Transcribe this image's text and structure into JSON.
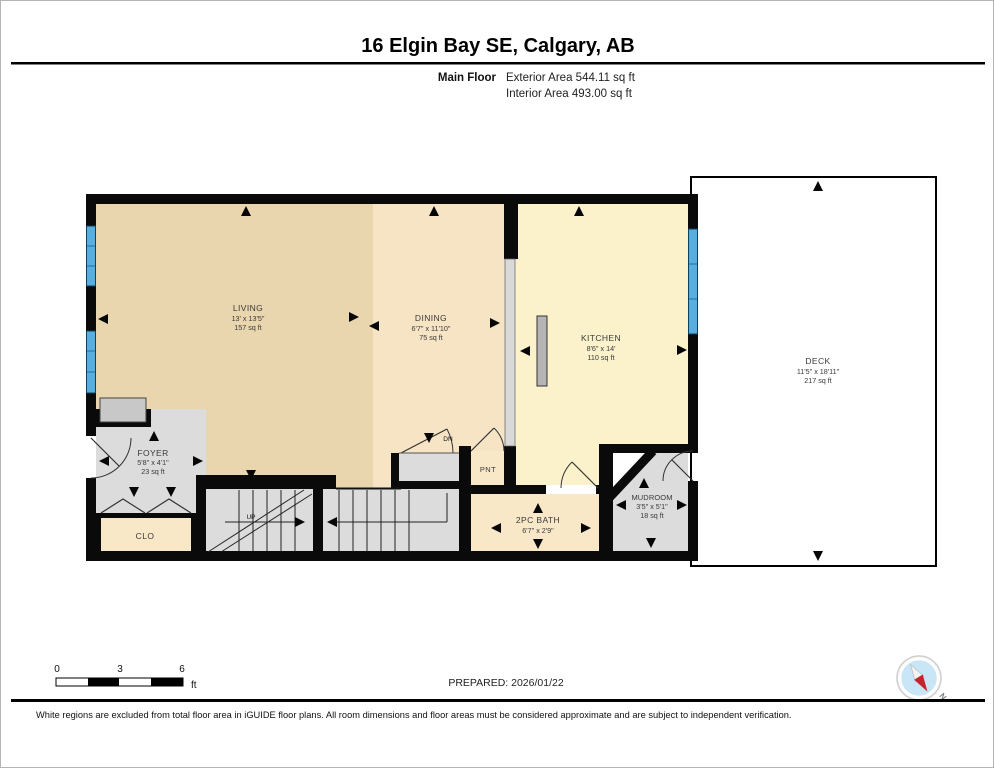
{
  "header": {
    "title": "16 Elgin Bay SE, Calgary, AB",
    "floor_label": "Main Floor",
    "exterior_area": "Exterior Area 544.11 sq ft",
    "interior_area": "Interior Area 493.00 sq ft"
  },
  "rooms": {
    "living": {
      "name": "LIVING",
      "dims": "13' x 13'5\"",
      "area": "157 sq ft"
    },
    "dining": {
      "name": "DINING",
      "dims": "6'7\" x 11'10\"",
      "area": "75 sq ft"
    },
    "kitchen": {
      "name": "KITCHEN",
      "dims": "8'6\" x 14'",
      "area": "110 sq ft"
    },
    "deck": {
      "name": "DECK",
      "dims": "11'5\" x 18'11\"",
      "area": "217 sq ft"
    },
    "foyer": {
      "name": "FOYER",
      "dims": "5'8\" x 4'1\"",
      "area": "23 sq ft"
    },
    "mudroom": {
      "name": "MUDROOM",
      "dims": "3'5\" x 5'1\"",
      "area": "18 sq ft"
    },
    "bath": {
      "name": "2PC BATH",
      "dims": "6'7\" x 2'9\""
    },
    "closet": {
      "name": "CLO"
    },
    "pantry": {
      "name": "PNT"
    }
  },
  "stairs": {
    "up": "UP",
    "down": "DN"
  },
  "scale_bar": {
    "ticks": [
      "0",
      "3",
      "6"
    ],
    "unit": "ft"
  },
  "compass": {
    "north": "N"
  },
  "footer": {
    "prepared": "PREPARED: 2026/01/22",
    "disclaimer": "White regions are excluded from total floor area in iGUIDE floor plans. All room dimensions and floor areas must be considered approximate and are subject to independent verification."
  },
  "colors": {
    "living": "#e9d6ae",
    "dining": "#f7e4c4",
    "kitchen": "#fbf2cc",
    "gray_room": "#dcdcdc",
    "small_room_peach": "#f8e8c8",
    "wall": "#0a0a0a",
    "window_blue": "#58aede",
    "compass_red": "#c5242c",
    "compass_blue": "#c9e6f6"
  }
}
